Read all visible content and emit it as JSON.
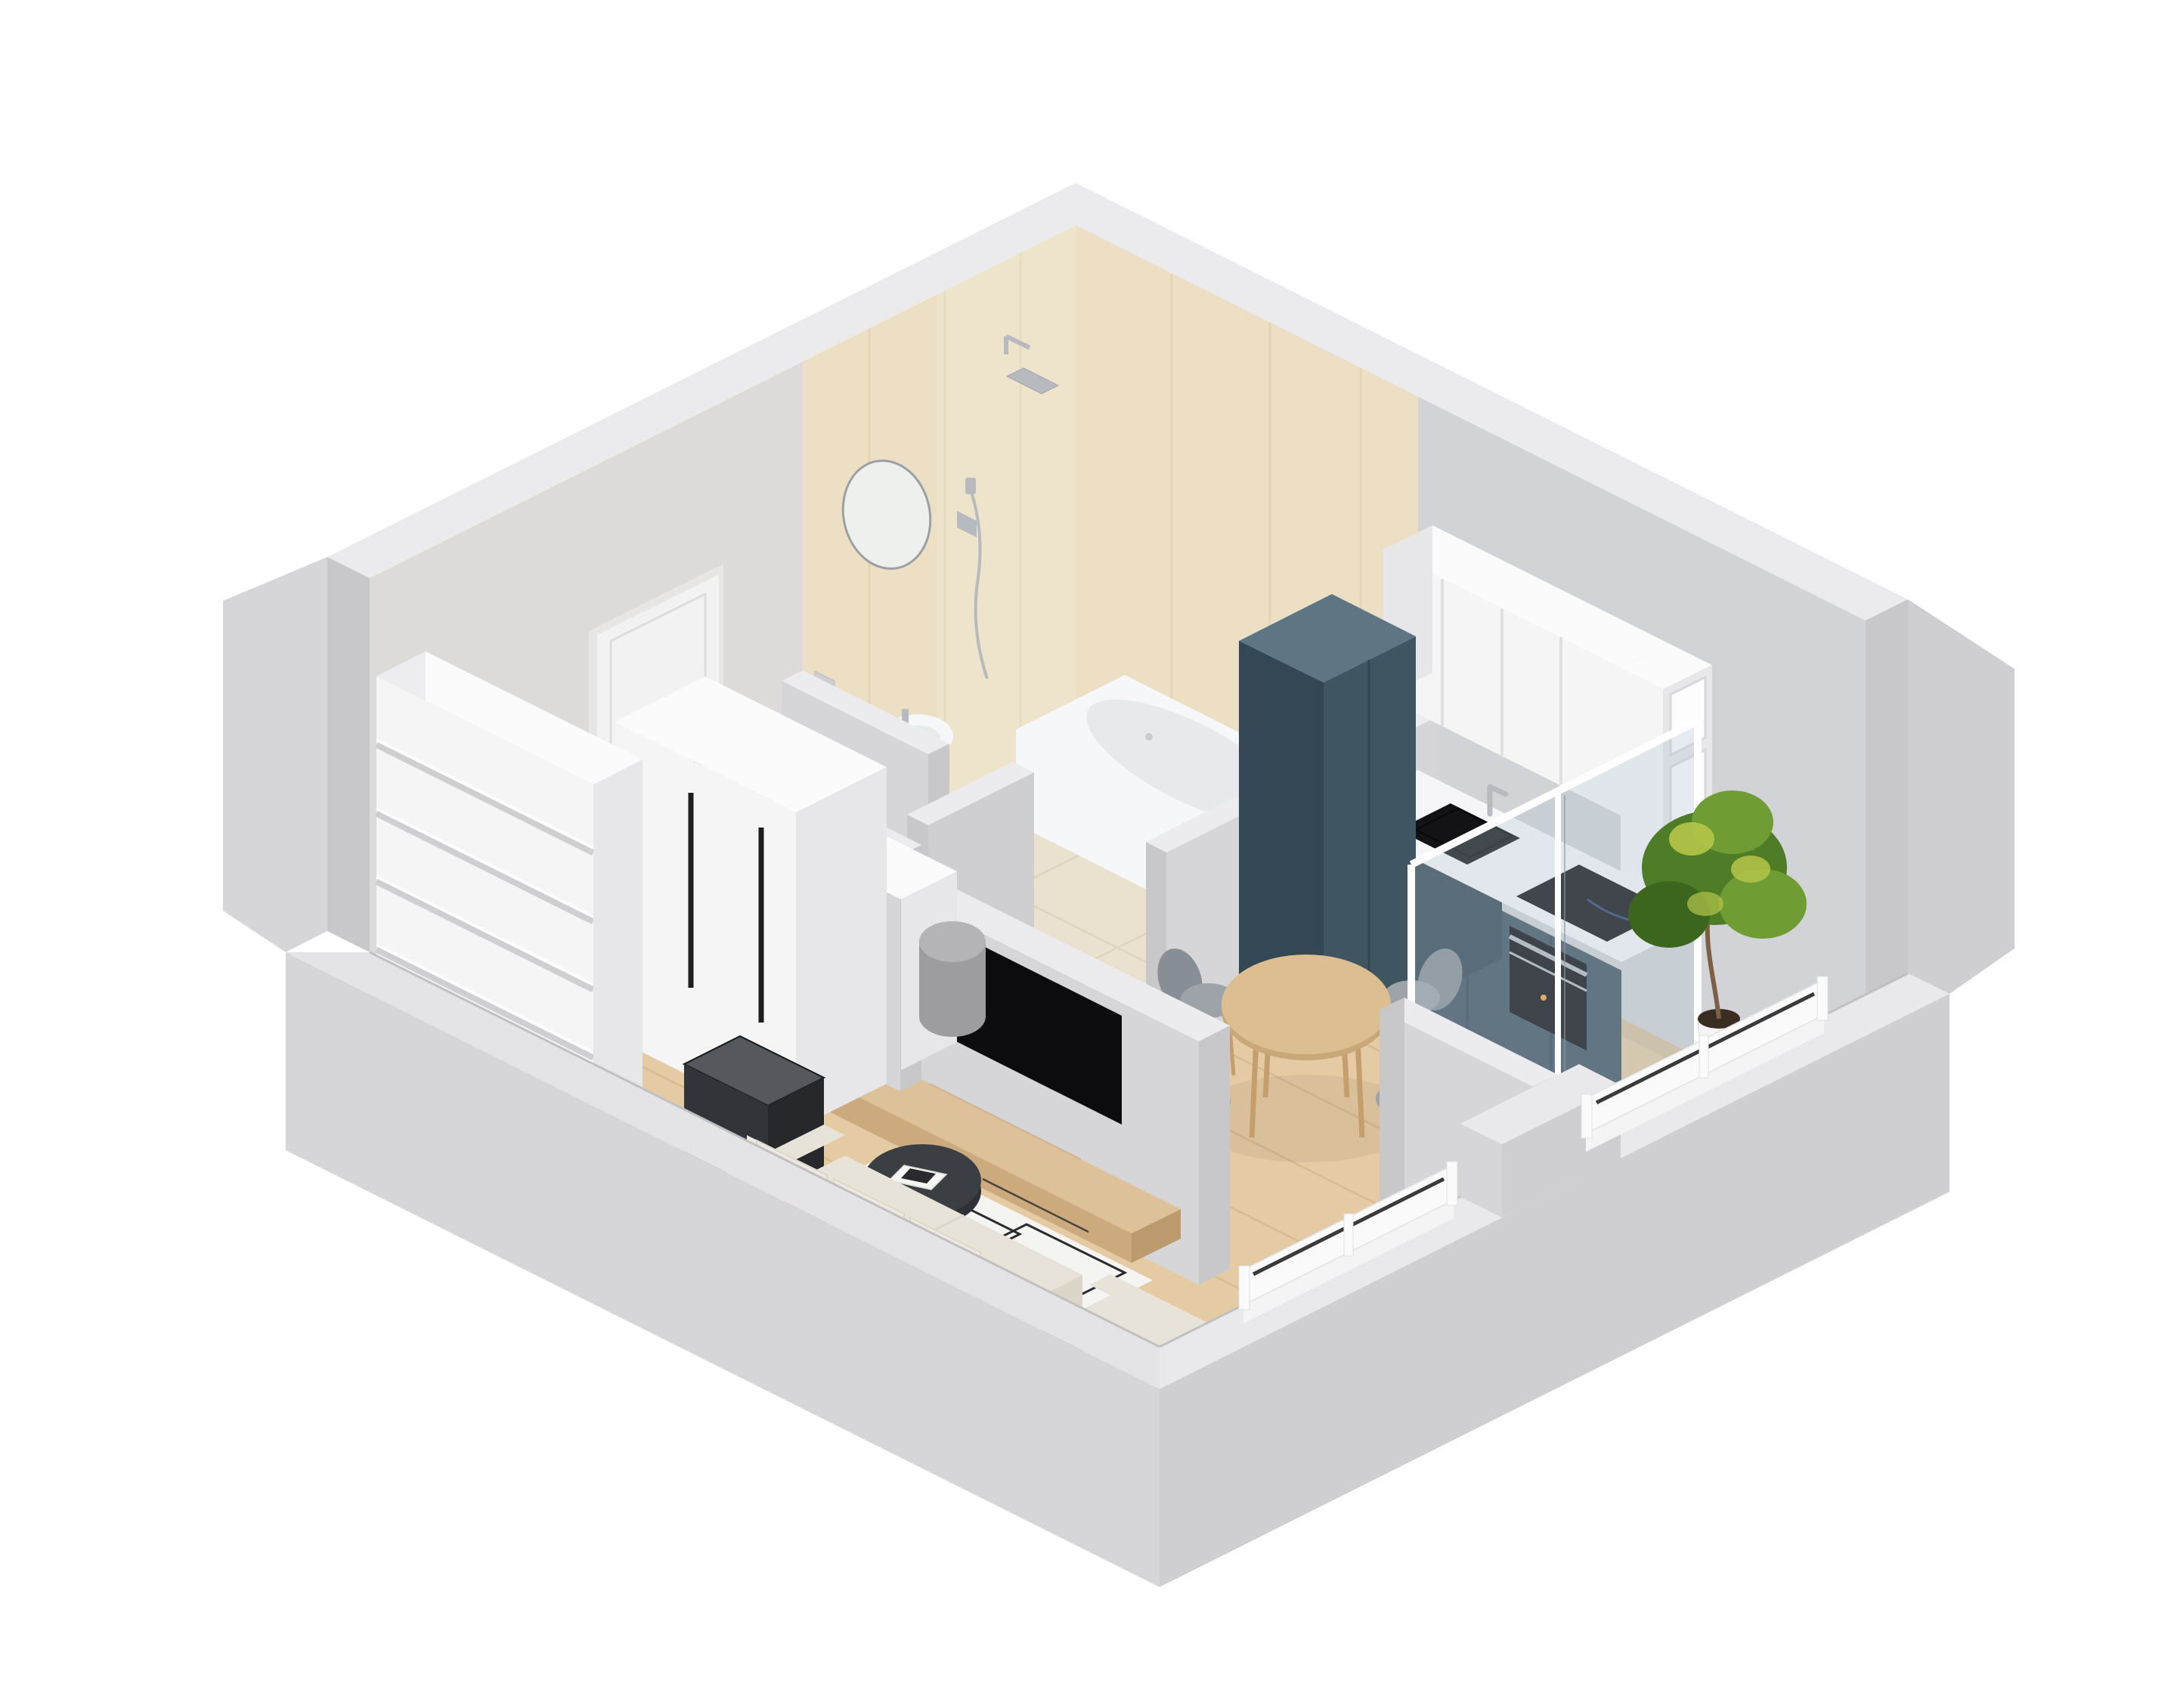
{
  "meta": {
    "description": "3D isometric cutaway floor-plan render of a studio apartment",
    "view": "axonometric dollhouse cutaway",
    "background": "#ffffff",
    "visible_text": []
  },
  "palette": {
    "bg": "#ffffff",
    "band": "#ebebed",
    "innerL": "#dcdbd9",
    "innerR": "#d2d3d6",
    "ext": "#d6d6d8",
    "extDark": "#cfcfd2",
    "end": "#c8c8cb",
    "marble": "#ecdfc4",
    "marbleHi": "#f3ecdb",
    "marbleLine": "#d9c49c",
    "wood": "#e5cba3",
    "woodLine": "#d5b88c",
    "bathFloor": "#eae2cf",
    "bathLine": "#dcd3bb",
    "balcFloor": "#ecdab6",
    "white": "#f5f5f6",
    "whiteSide": "#e7e7e9",
    "whiteTop": "#fbfbfc",
    "counter": "#f6f6f8",
    "teal": "#3f5561",
    "tealDark": "#344754",
    "tealTop": "#5e7583",
    "black": "#131316",
    "steel": "#b7bbbf",
    "tableWood": "#dcbe90",
    "tableEdge": "#c8a878",
    "chair": "#9da3a9",
    "chairDark": "#888e95",
    "legWood": "#c59e6d",
    "sofa": "#e8e3d9",
    "sofaSide": "#dcd6c9",
    "sofaBack": "#eee9e0",
    "rust": "#b35d39",
    "rust2": "#a04e2d",
    "rug": "#f4f4f2",
    "rugLine": "#2b2b2e",
    "coffee": "#3b3e42",
    "coffeeDark": "#2e3135",
    "tv": "#0c0c0e",
    "consoleTop": "#ddc199",
    "consoleFront": "#cbaa7e",
    "consoleEnd": "#bb9a6e",
    "rail": "#fafafa",
    "glassTint": "rgba(174,196,207,0.30)",
    "plantDark": "#3c651e",
    "plantMid": "#4f7c26",
    "plantLight": "#6f9c33",
    "plantAccent": "#b5c64a",
    "pot": "#f4f4f4",
    "soil": "#3a2e22",
    "stand": "#c08a50",
    "trunk": "#7d5f43",
    "poufTop": "#b4b4b6",
    "pouf": "#9d9da0",
    "door": "#f2f2f2",
    "doorFrame": "#e6e6e4",
    "mat": "#c9cacd",
    "fix": "#f6f7f9",
    "fixShade": "#e7eaed",
    "shadow": "#000000"
  },
  "rooms": [
    {
      "id": "bathroom",
      "label": "Bathroom",
      "items": [
        "marble-feature-walls",
        "rain-shower",
        "shower-mixer",
        "hand-shower",
        "round-mirror",
        "pedestal-sink",
        "toilet",
        "bathtub",
        "tile-floor",
        "low-partition"
      ]
    },
    {
      "id": "hallway",
      "label": "Entry hall",
      "items": [
        "entry-door",
        "door-mat",
        "light-switch",
        "tall-bookshelf",
        "dark-storage-box",
        "sideboard",
        "wardrobe",
        "gray-pouf",
        "wood-floor"
      ]
    },
    {
      "id": "kitchen",
      "label": "Kitchen",
      "items": [
        "white-upper-cabinets",
        "open-shelf-column",
        "white-countertop",
        "black-sink",
        "chrome-faucet",
        "induction-cooktop",
        "built-in-oven",
        "teal-base-cabinets",
        "tall-teal-pantry"
      ]
    },
    {
      "id": "dining",
      "label": "Dining area",
      "items": [
        "round-wood-table",
        "upholstered-chair-1",
        "upholstered-chair-2",
        "upholstered-chair-3",
        "upholstered-chair-4"
      ]
    },
    {
      "id": "living",
      "label": "Living room",
      "items": [
        "l-shaped-sofa",
        "armchair-module",
        "terracotta-pillows",
        "geometric-rug",
        "round-coffee-table",
        "magazines",
        "wall-tv",
        "floating-wood-console",
        "tv-partition-wall"
      ]
    },
    {
      "id": "balcony",
      "label": "Balcony",
      "items": [
        "glass-partition",
        "potted-plant",
        "wood-deck",
        "white-railing",
        "parapet-wall"
      ]
    }
  ],
  "counts": {
    "dining_chairs": 4,
    "bookshelf_shelves": 6,
    "upper_cabinet_doors": 4,
    "open_shelf_cubbies": 3,
    "rust_pillows": 2,
    "railing_sections": 2
  }
}
